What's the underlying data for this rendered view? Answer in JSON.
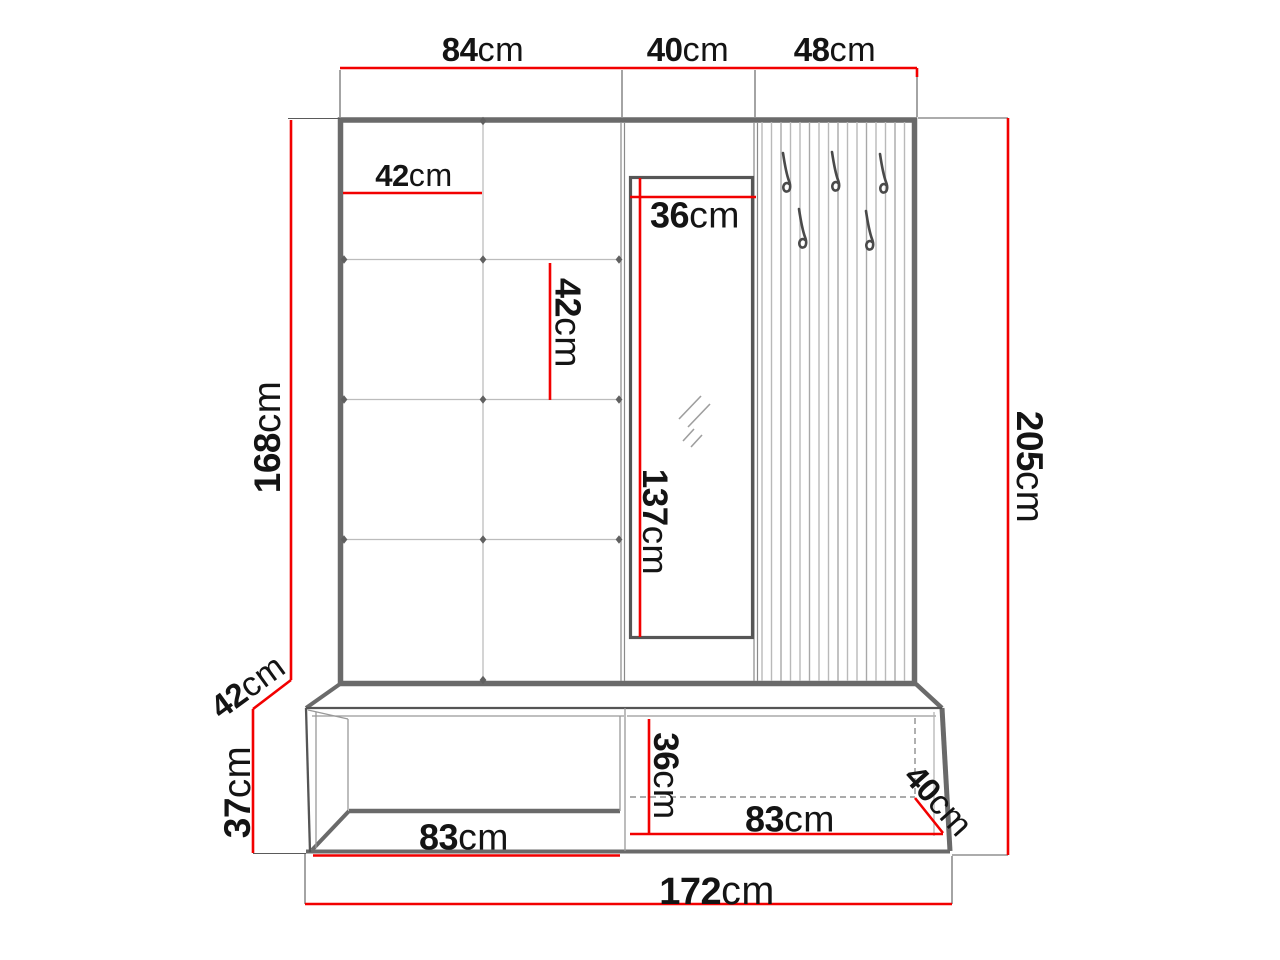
{
  "diagram": {
    "unit": "cm",
    "colors": {
      "dimension_line": "#f20000",
      "structure": "#6a6a6a",
      "text": "#141414"
    },
    "hooks": {
      "count": 5,
      "icon": "coat-hook"
    },
    "dimensions": {
      "top_section_1": {
        "value": "84",
        "unit": "cm"
      },
      "top_section_2": {
        "value": "40",
        "unit": "cm"
      },
      "top_section_3": {
        "value": "48",
        "unit": "cm"
      },
      "panel_height": {
        "value": "168",
        "unit": "cm"
      },
      "total_height": {
        "value": "205",
        "unit": "cm"
      },
      "tile_width": {
        "value": "42",
        "unit": "cm"
      },
      "tile_height": {
        "value": "42",
        "unit": "cm"
      },
      "mirror_width": {
        "value": "36",
        "unit": "cm"
      },
      "mirror_height": {
        "value": "137",
        "unit": "cm"
      },
      "bench_depth_left": {
        "value": "42",
        "unit": "cm"
      },
      "bench_height": {
        "value": "37",
        "unit": "cm"
      },
      "bench_inner_height": {
        "value": "36",
        "unit": "cm"
      },
      "bench_left_width": {
        "value": "83",
        "unit": "cm"
      },
      "bench_right_width": {
        "value": "83",
        "unit": "cm"
      },
      "bench_depth_right": {
        "value": "40",
        "unit": "cm"
      },
      "total_width": {
        "value": "172",
        "unit": "cm"
      }
    }
  }
}
